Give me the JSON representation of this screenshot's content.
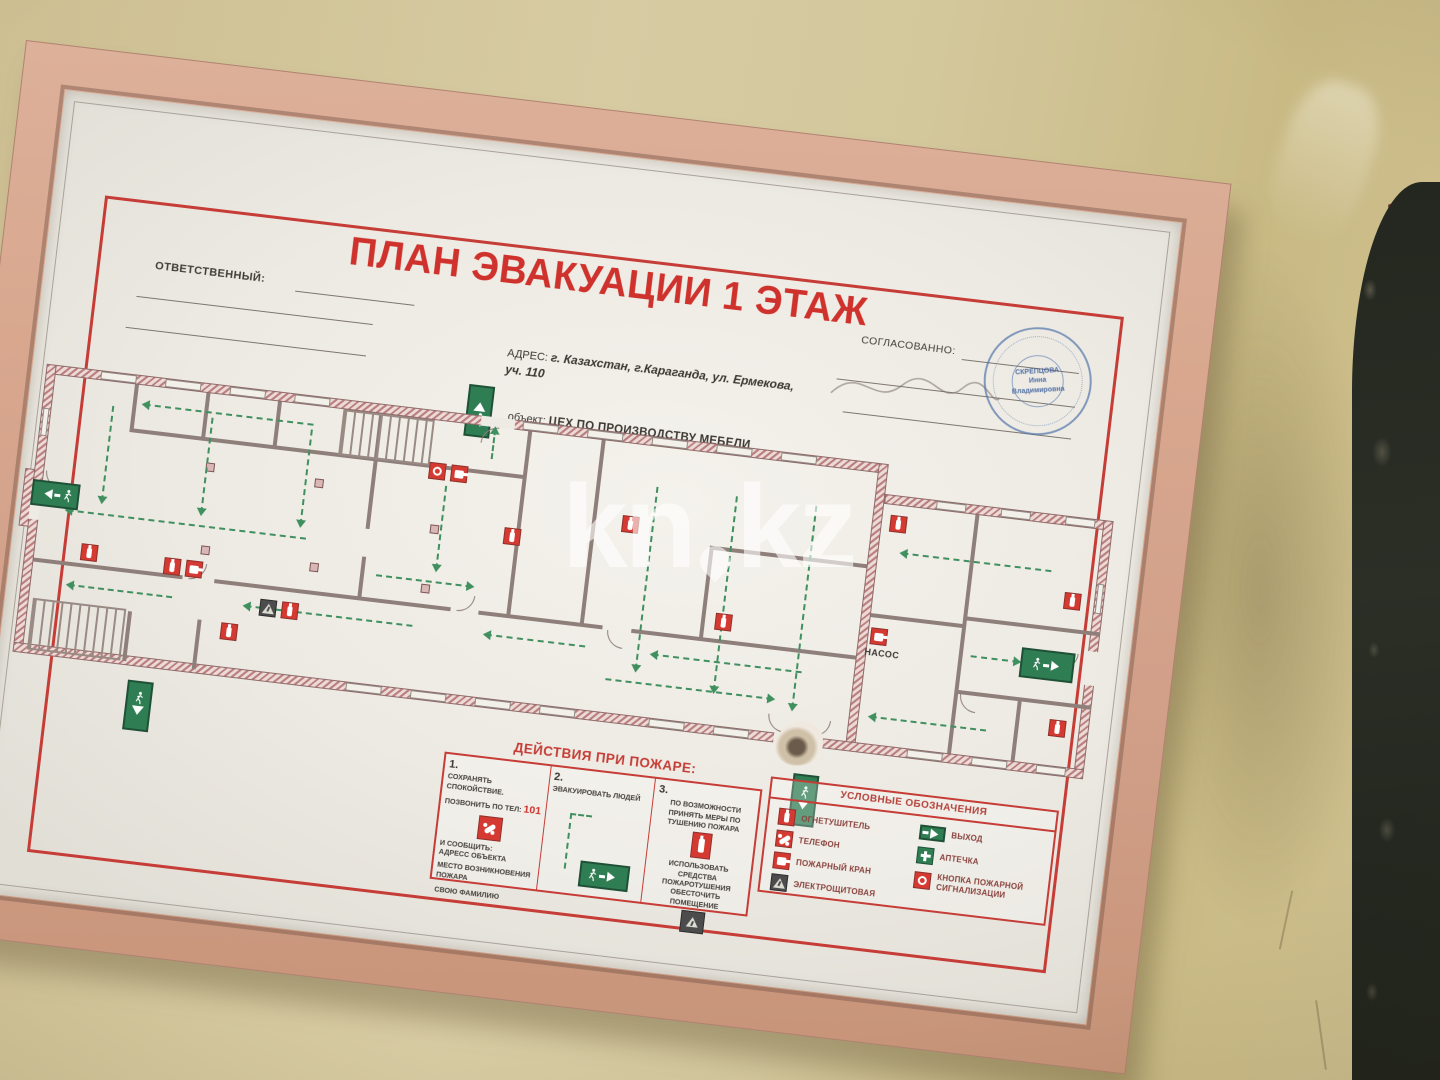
{
  "poster": {
    "title": "ПЛАН ЭВАКУАЦИИ 1 ЭТАЖ",
    "responsible_label": "ОТВЕТСТВЕННЫЙ:",
    "approved_label": "СОГЛАСОВАННО:",
    "address_label": "АДРЕС:",
    "address_value": "г. Казахстан, г.Караганда, ул. Ермекова, уч. 110",
    "object_label": "объект:",
    "object_value": "ЦЕХ ПО ПРОИЗВОДСТВУ МЕБЕЛИ",
    "stamp": {
      "line1": "СКРЕПЦОВА",
      "line2": "Инна",
      "line3": "Владимировна"
    },
    "plan": {
      "pump_room_label": "НАСОС"
    },
    "actions": {
      "title": "ДЕЙСТВИЯ ПРИ ПОЖАРЕ:",
      "step1": {
        "num": "1.",
        "line1": "СОХРАНЯТЬ СПОКОЙСТВИЕ.",
        "line2": "ПОЗВОНИТЬ ПО ТЕЛ:",
        "phone": "101",
        "line3": "И СООБЩИТЬ:",
        "line4": "АДРЕСС ОБЪЕКТА",
        "line5": "МЕСТО ВОЗНИКНОВЕНИЯ ПОЖАРА",
        "line6": "СВОЮ ФАМИЛИЮ"
      },
      "step2": {
        "num": "2.",
        "line1": "ЭВАКУИРОВАТЬ ЛЮДЕЙ"
      },
      "step3": {
        "num": "3.",
        "line1": "ПО ВОЗМОЖНОСТИ ПРИНЯТЬ МЕРЫ ПО ТУШЕНИЮ ПОЖАРА",
        "line2": "ИСПОЛЬЗОВАТЬ СРЕДСТВА ПОЖАРОТУШЕНИЯ",
        "line3": "ОБЕСТОЧИТЬ ПОМЕЩЕНИЕ"
      }
    },
    "legend": {
      "title": "УСЛОВНЫЕ ОБОЗНАЧЕНИЯ",
      "items_left": [
        {
          "icon": "fire-extinguisher-icon",
          "label": "ОГНЕТУШИТЕЛЬ"
        },
        {
          "icon": "telephone-icon",
          "label": "ТЕЛЕФОН"
        },
        {
          "icon": "fire-hydrant-icon",
          "label": "ПОЖАРНЫЙ КРАН"
        },
        {
          "icon": "electrical-room-icon",
          "label": "ЭЛЕКТРОЩИТОВАЯ"
        }
      ],
      "items_right": [
        {
          "icon": "exit-sign-icon",
          "label": "ВЫХОД"
        },
        {
          "icon": "first-aid-kit-icon",
          "label": "АПТЕЧКА"
        },
        {
          "icon": "fire-alarm-button-icon",
          "label": "КНОПКА ПОЖАРНОЙ СИГНАЛИЗАЦИИ"
        }
      ]
    },
    "colors": {
      "accent_red": "#cf322c",
      "exit_green": "#2f7d52",
      "stamp_blue": "#5e82b4",
      "frame_wood": "#d7a78f",
      "wall": "#d2c59b"
    }
  },
  "watermark": {
    "left": "kn",
    "right": "kz"
  }
}
